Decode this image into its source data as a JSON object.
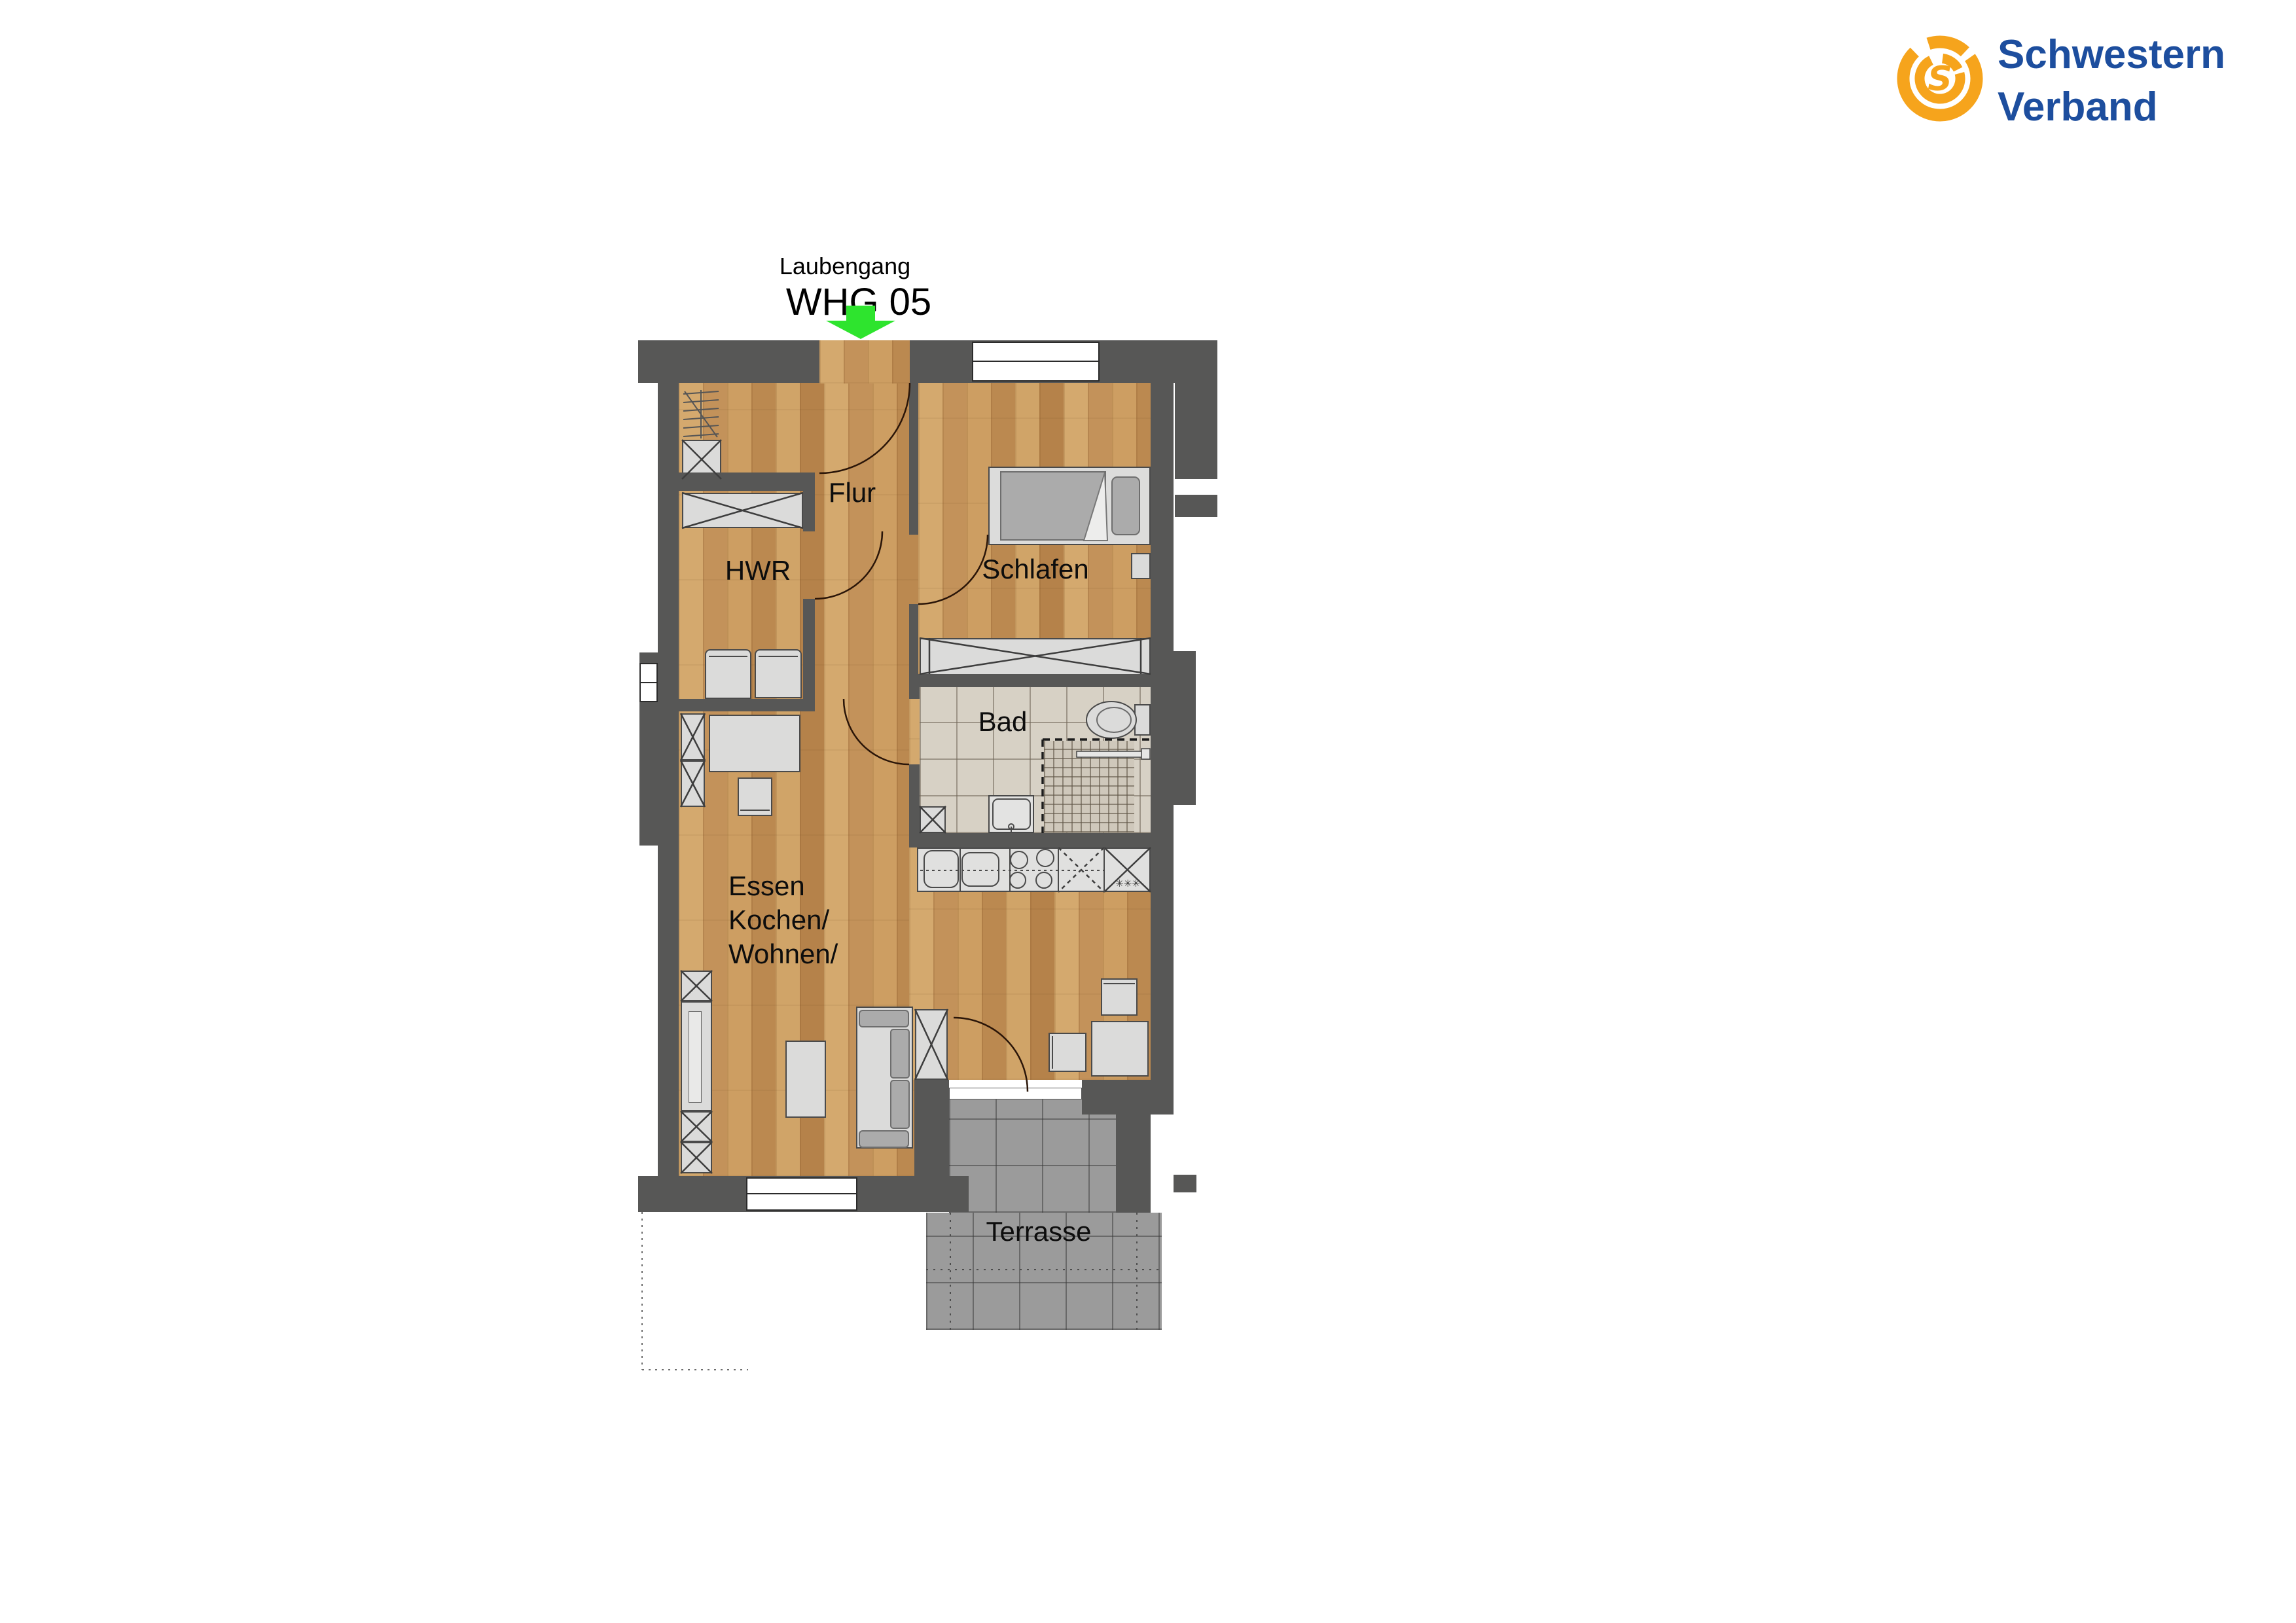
{
  "header": {
    "area_label": "Laubengang",
    "unit_label": "WHG 05"
  },
  "logo": {
    "line1": "Schwestern",
    "line2": "Verband"
  },
  "rooms": {
    "flur": "Flur",
    "hwr": "HWR",
    "schlafen": "Schlafen",
    "bad": "Bad",
    "wohnen_lines": [
      "Essen",
      "Kochen/",
      "Wohnen/"
    ],
    "terrasse": "Terrasse"
  },
  "annotations": {
    "freezer_stars": "✳✳✳"
  },
  "colors": {
    "wall": "#575756",
    "wood_floor": "#C89A5F",
    "bath_tile": "#D7D1C5",
    "terrace_tile": "#9B9B9B",
    "furniture": "#DBDBDA",
    "cushion": "#ABABAB",
    "entrance_arrow_green": "#2EE42E",
    "logo_orange": "#F6A41C",
    "logo_blue": "#1D4E9E",
    "label_text": "#0D0D0D"
  }
}
